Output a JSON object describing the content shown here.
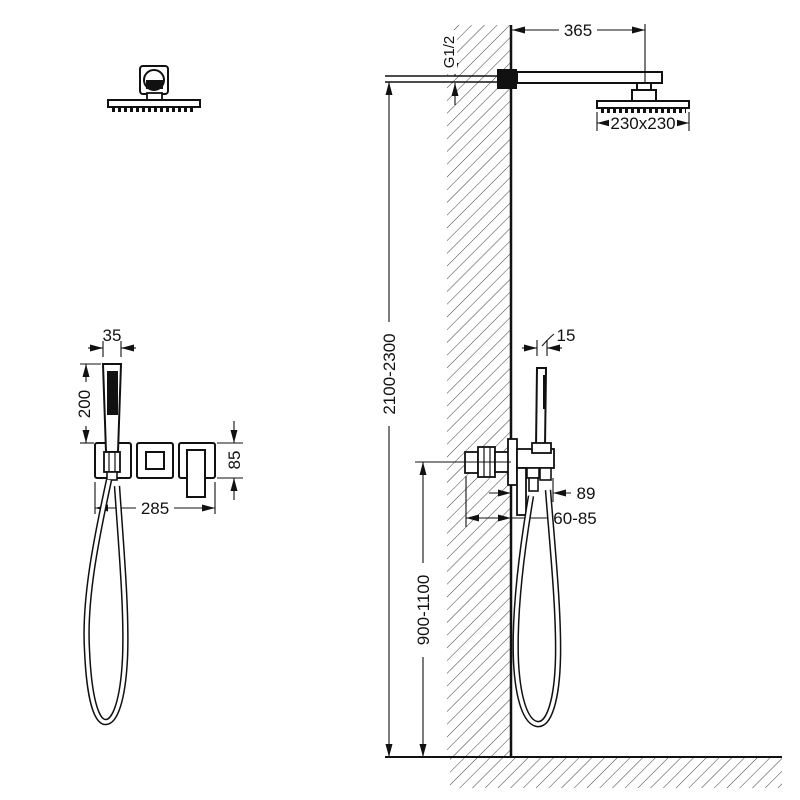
{
  "drawing": {
    "type": "installation-diagram",
    "subject": "concealed shower system with overhead rain shower, hand shower and in-wall mixer",
    "views": [
      "front-view",
      "side-view-wall-section"
    ],
    "colors": {
      "line": "#111111",
      "hatch": "#3f3f3f",
      "background": "#ffffff"
    }
  },
  "dims": {
    "handset_width": "35",
    "handset_length": "200",
    "trim_width": "285",
    "trim_height": "85",
    "arm_length": "365",
    "thread": "G1/2",
    "head_size": "230x230",
    "mount_height_range": "2100-2300",
    "handset_thickness": "15",
    "projection": "89",
    "rough_in_depth": "60-85",
    "mixer_height_range": "900-1100"
  }
}
